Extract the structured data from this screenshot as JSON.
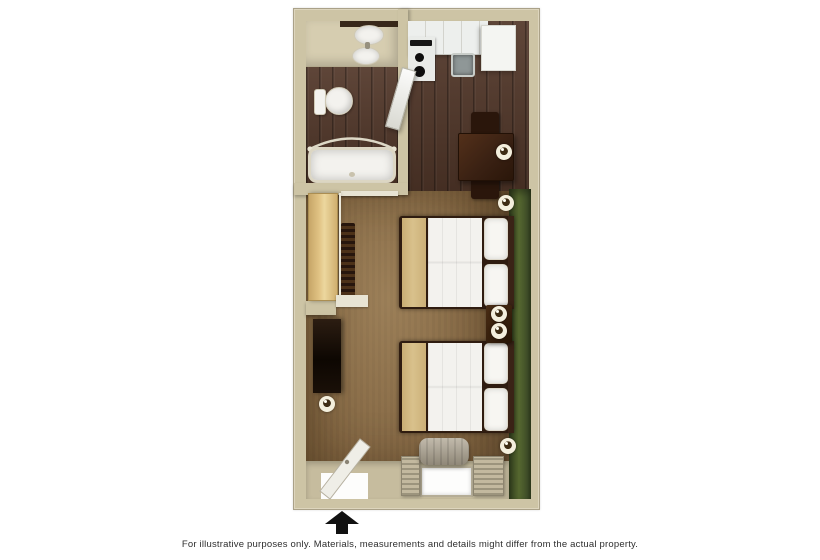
{
  "disclaimer": "For illustrative purposes only.  Materials, measurements and details might differ from the actual property.",
  "floorplan": {
    "type": "studio-suite-top-view",
    "entrance_marker": "black-arrow-at-bottom-door",
    "rooms": {
      "bathroom": {
        "fixtures": [
          "vanity-sink",
          "toilet",
          "bathtub",
          "shower-curtain-rod"
        ]
      },
      "kitchen": {
        "fixtures": [
          "counter-cabinets",
          "stove",
          "kitchen-sink",
          "refrigerator",
          "open-bathroom-door",
          "dining-table",
          "dining-chair-top",
          "dining-chair-bottom",
          "table-lamp"
        ]
      },
      "main_room": {
        "fixtures": [
          "closet-sliding-door",
          "hanging-clothes",
          "tv-dresser",
          "bed-1",
          "bed-2",
          "nightstand",
          "lamps-x6",
          "window",
          "curtains",
          "ac-unit",
          "entry-door",
          "green-accent-wall"
        ]
      }
    }
  },
  "colors": {
    "wall_beige": "#cdc4a5",
    "wood_floor": "#53382a",
    "carpet": "#846743",
    "accent_green": "#55672f",
    "furniture_brown": "#3a2113",
    "blanket_tan": "#d9c18c",
    "closet_tan": "#e0c283",
    "fixture_white": "#f3f2ee",
    "arrow_black": "#111111"
  }
}
